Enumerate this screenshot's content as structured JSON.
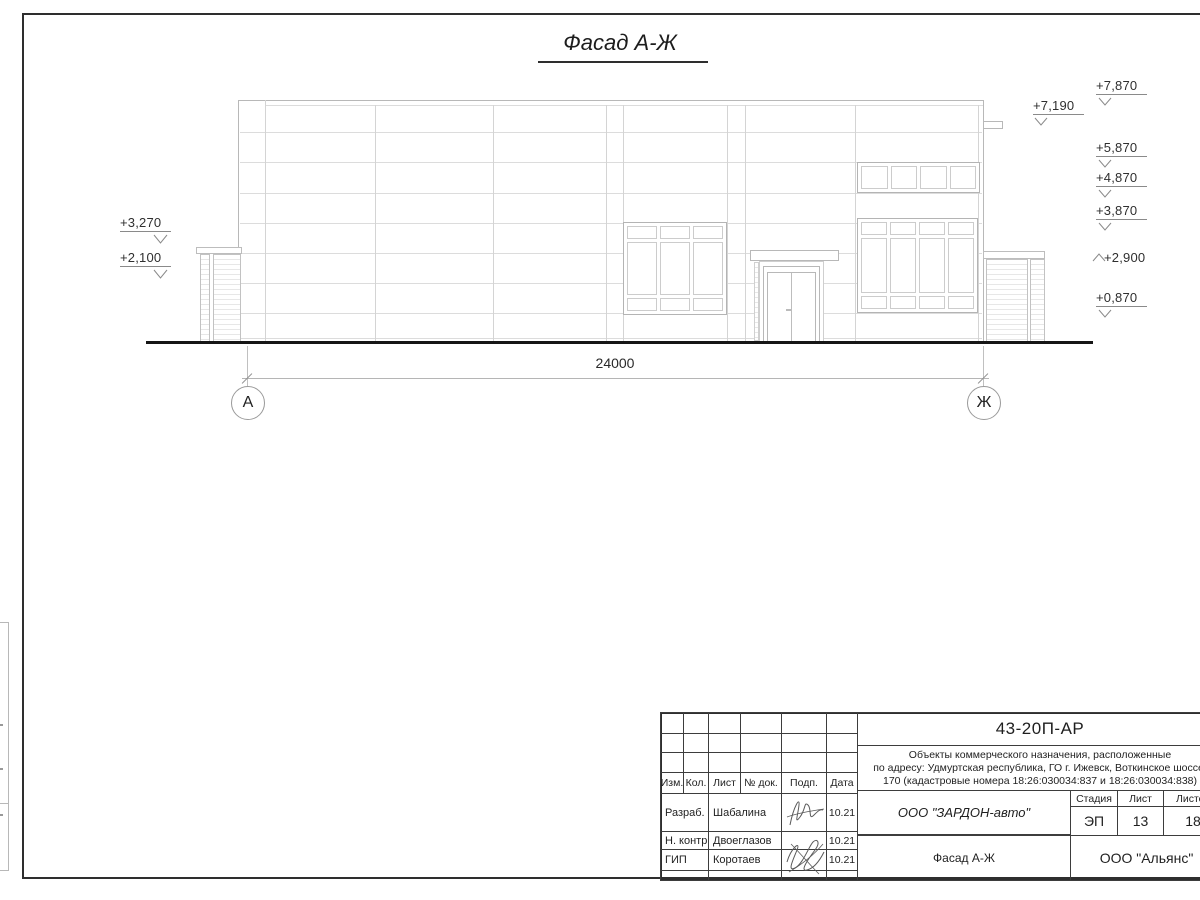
{
  "title": "Фасад А-Ж",
  "drawing": {
    "dimension_label": "24000",
    "axis_left": "А",
    "axis_right": "Ж",
    "elev_left": [
      {
        "label": "+3,270"
      },
      {
        "label": "+2,100"
      }
    ],
    "elev_right": [
      {
        "label": "+7,870"
      },
      {
        "label": "+7,190"
      },
      {
        "label": "+5,870"
      },
      {
        "label": "+4,870"
      },
      {
        "label": "+3,870"
      },
      {
        "label": "+2,900"
      },
      {
        "label": "+0,870"
      }
    ]
  },
  "titleblock": {
    "doc_number": "43-20П-АР",
    "description_lines": [
      "Объекты коммерческого назначения, расположенные",
      "по адресу: Удмуртская республика, ГО г. Ижевск, Воткинское шоссе,",
      "170 (кадастровые номера 18:26:030034:837 и 18:26:030034:838)"
    ],
    "headers": [
      "Изм.",
      "Кол.",
      "Лист",
      "№ док.",
      "Подп.",
      "Дата"
    ],
    "rows": [
      {
        "role": "Разраб.",
        "name": "Шабалина",
        "date": "10.21"
      },
      {
        "role": "Н. контр.",
        "name": "Двоеглазов",
        "date": "10.21"
      },
      {
        "role": "ГИП",
        "name": "Коротаев",
        "date": "10.21"
      }
    ],
    "company": "ООО \"ЗАРДОН-авто\"",
    "stage_label": "Стадия",
    "sheet_label": "Лист",
    "sheets_label": "Листов",
    "stage": "ЭП",
    "sheet": "13",
    "sheets": "18",
    "drawing_name": "Фасад А-Ж",
    "org": "ООО \"Альянс\""
  }
}
